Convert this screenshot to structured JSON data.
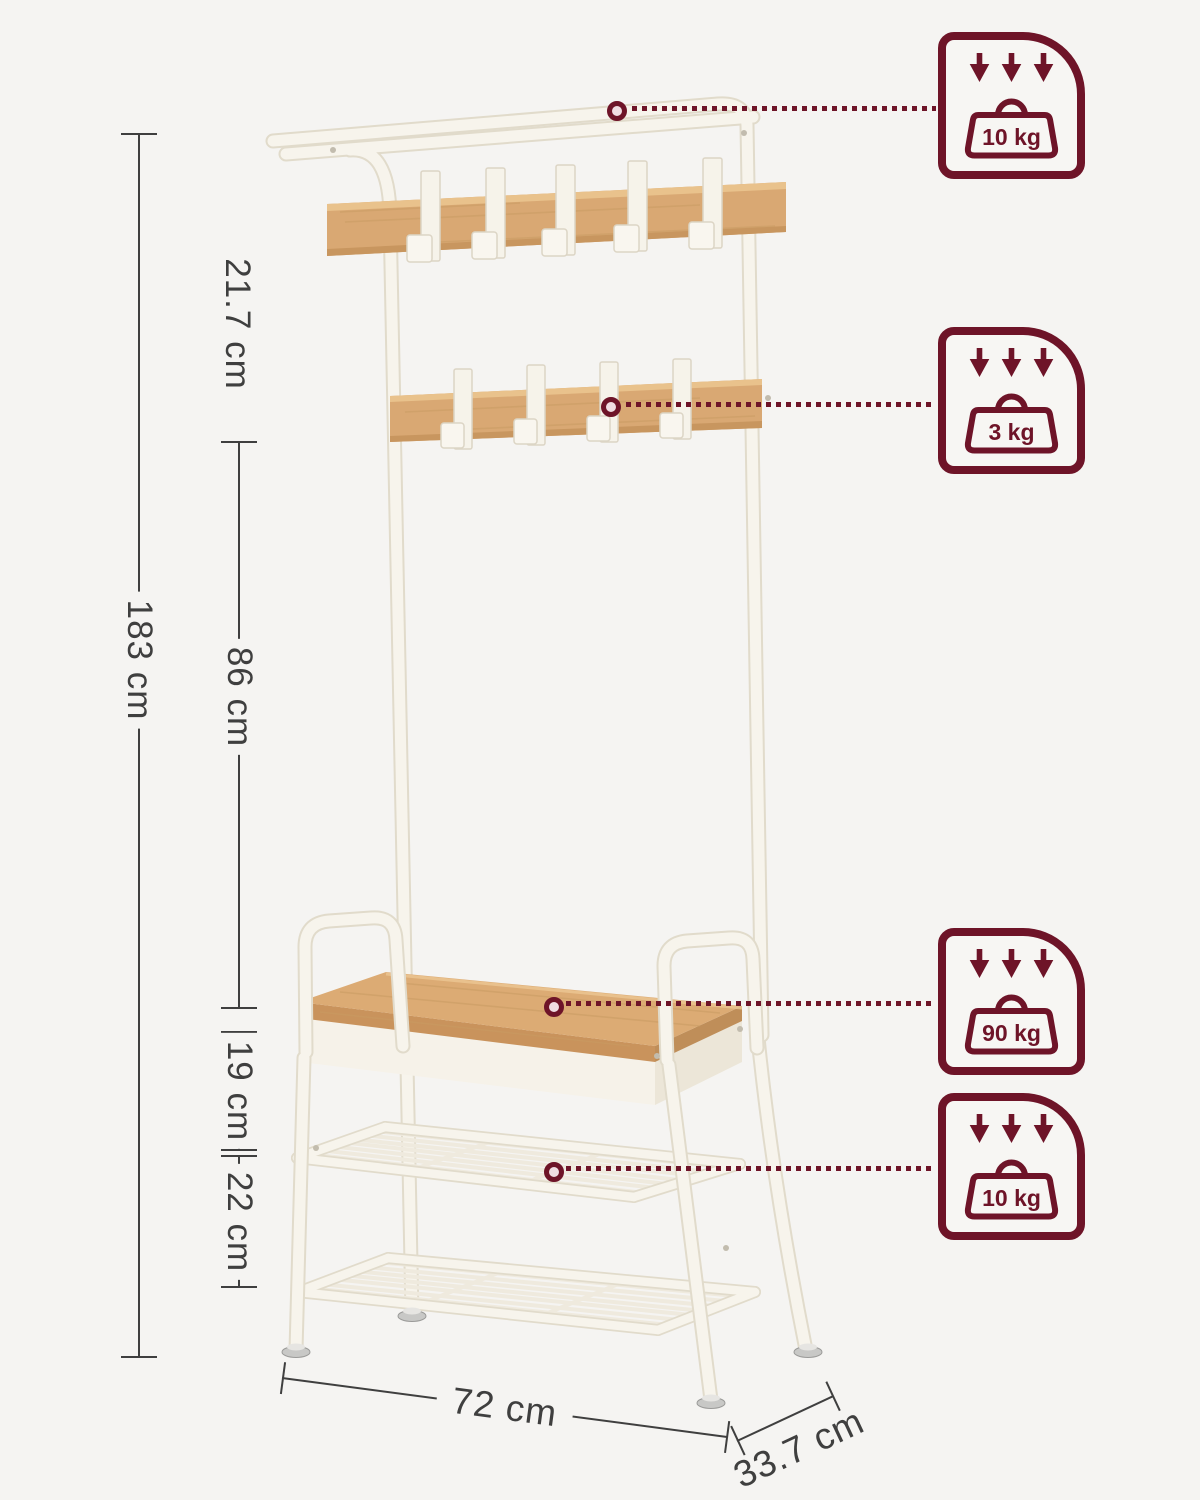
{
  "page": {
    "width": 1200,
    "height": 1500,
    "background": "#f5f4f2"
  },
  "product": {
    "name": "Hall tree coat rack with shoe bench, hooks and wire shelves",
    "frame_color": "#f7f4ec",
    "wood_color": "#d9a873"
  },
  "accent_colors": {
    "maroon": "#6e1428",
    "dimension_line": "#3f3f3f"
  },
  "dimensions": {
    "total_height": "183 cm",
    "hook_rail_spacing": "21.7 cm",
    "rail_to_bench": "86 cm",
    "bench_to_shelf": "19 cm",
    "shelf_spacing": "22 cm",
    "width": "72 cm",
    "depth": "33.7 cm"
  },
  "capacity_badges": [
    {
      "id": "top-shelf",
      "load": "10 kg"
    },
    {
      "id": "hook-rail",
      "load": "3 kg"
    },
    {
      "id": "bench-seat",
      "load": "90 kg"
    },
    {
      "id": "wire-shelf",
      "load": "10 kg"
    }
  ]
}
